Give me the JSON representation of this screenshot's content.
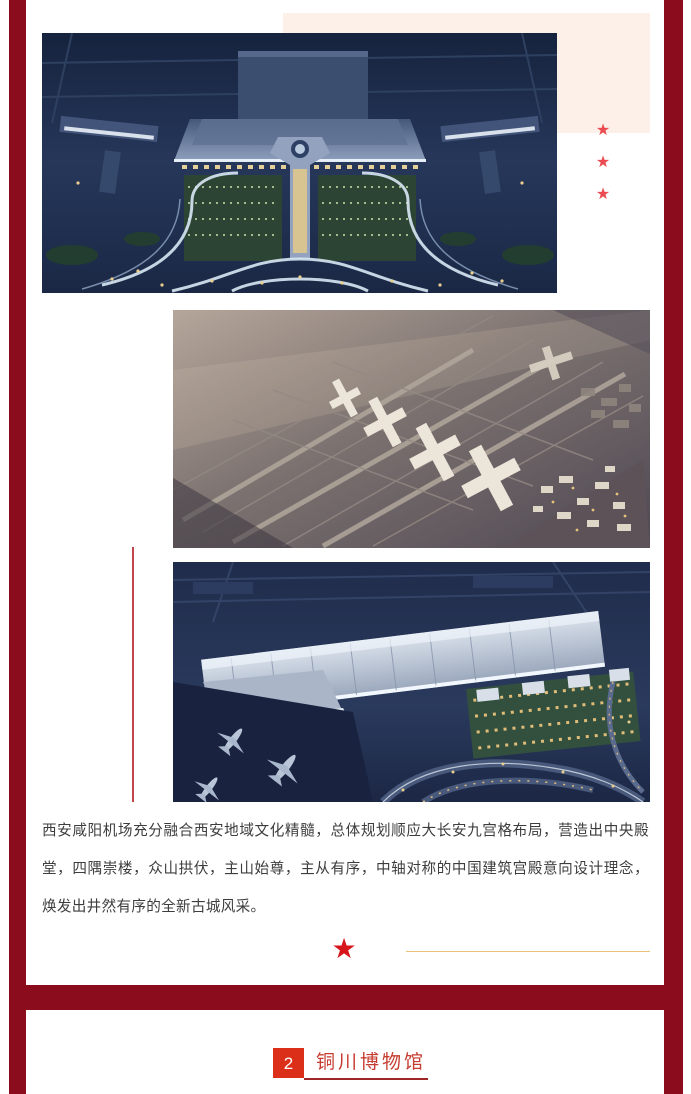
{
  "page": {
    "background_color": "#ffffff",
    "frame_color": "#8a0c1d"
  },
  "decor": {
    "star_glyph": "★",
    "side_star_color": "#ea4a50",
    "side_star_count": 3,
    "center_star_color": "#d6161b",
    "gold_line_color": "#e9c27c",
    "vertical_line_color": "#c2454b",
    "pink_box_color": "#fcf0e8"
  },
  "images": [
    {
      "name": "airport-terminal-night-aerial"
    },
    {
      "name": "airport-masterplan-dusk-aerial"
    },
    {
      "name": "airport-terminal-dusk-render"
    }
  ],
  "article": {
    "paragraph": "西安咸阳机场充分融合西安地域文化精髓，总体规划顺应大长安九宫格布局，营造出中央殿堂，四隅崇楼，众山拱伏，主山始尊，主从有序，中轴对称的中国建筑宫殿意向设计理念，焕发出井然有序的全新古城风采。",
    "text_color": "#3d3d3d"
  },
  "section_header": {
    "number": "2",
    "title": "铜川博物馆",
    "badge_color": "#dc2f1a",
    "title_color": "#c63c30",
    "underline_color": "#9e2626"
  }
}
